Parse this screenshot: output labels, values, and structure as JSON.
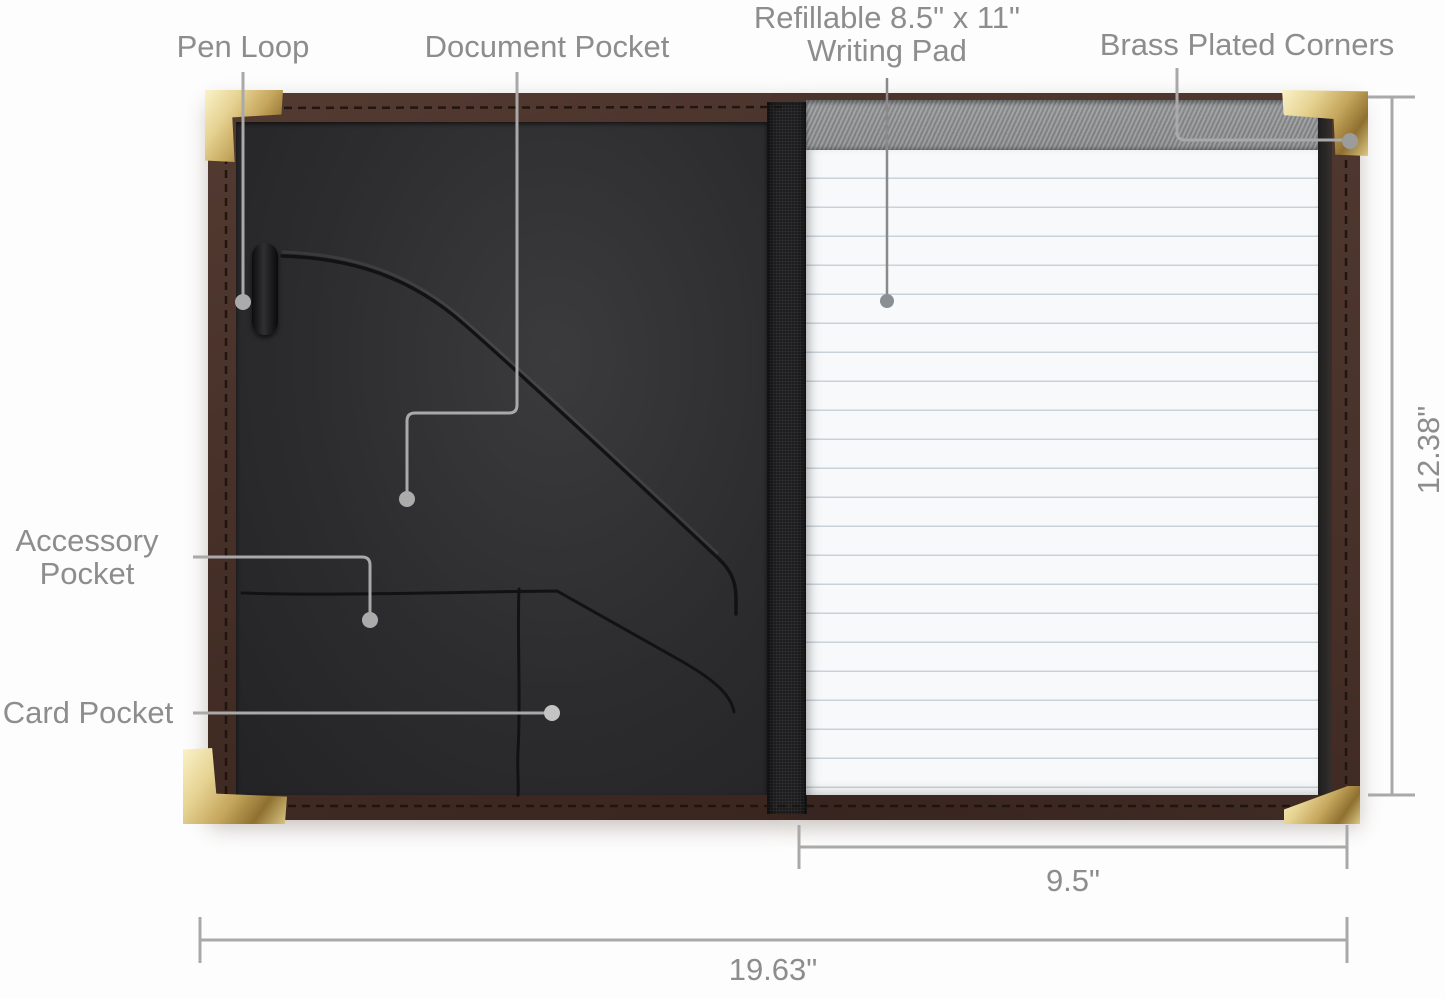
{
  "diagram_title": "padfolio-features-and-dimensions",
  "callouts": {
    "pen_loop": {
      "label": "Pen Loop"
    },
    "document_pocket": {
      "label": "Document Pocket"
    },
    "writing_pad": {
      "label_line1": "Refillable 8.5\" x 11\"",
      "label_line2": "Writing Pad"
    },
    "brass_corners": {
      "label": "Brass Plated Corners"
    },
    "accessory_pocket": {
      "label_line1": "Accessory",
      "label_line2": "Pocket"
    },
    "card_pocket": {
      "label": "Card Pocket"
    }
  },
  "dimensions": {
    "height": "12.38\"",
    "pad_width": "9.5\"",
    "overall_width": "19.63\""
  },
  "colors": {
    "leather_brown": "#463028",
    "interior_black": "#2c2c2e",
    "binding_gray": "#8f9092",
    "paper_white": "#f7f9fa",
    "paper_line": "#c9d2db",
    "brass_gold": "#d9c077",
    "leader_gray": "#a9a9a9",
    "label_gray": "#8d8d8d"
  }
}
